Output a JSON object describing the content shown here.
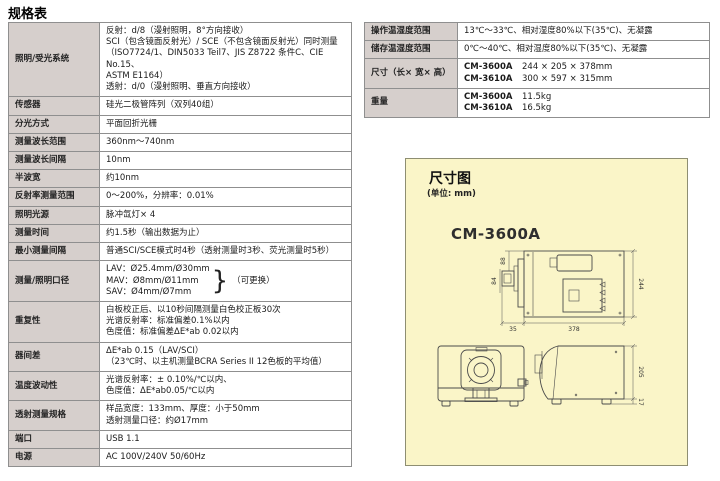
{
  "page": {
    "title": "规格表"
  },
  "left_table": {
    "rows": [
      {
        "label": "照明/受光系统",
        "lines": [
          "反射：d/8（漫射照明，8°方向接收）",
          "SCI（包含镜面反射光）/ SCE（不包含镜面反射光）同时测量",
          "（ISO7724/1、DIN5033 Teil7、JIS Z8722 条件C、CIE No.15、",
          "ASTM E1164）",
          "透射：d/0（漫射照明、垂直方向接收）"
        ]
      },
      {
        "label": "传感器",
        "lines": [
          "硅光二极管阵列（双列40组）"
        ]
      },
      {
        "label": "分光方式",
        "lines": [
          "平面回折光栅"
        ]
      },
      {
        "label": "测量波长范围",
        "lines": [
          "360nm～740nm"
        ]
      },
      {
        "label": "测量波长间隔",
        "lines": [
          "10nm"
        ]
      },
      {
        "label": "半波宽",
        "lines": [
          "约10nm"
        ]
      },
      {
        "label": "反射率测量范围",
        "lines": [
          "0～200%，分辨率：0.01%"
        ]
      },
      {
        "label": "照明光源",
        "lines": [
          "脉冲氙灯× 4"
        ]
      },
      {
        "label": "测量时间",
        "lines": [
          "约1.5秒（输出数据为止）"
        ]
      },
      {
        "label": "最小测量间隔",
        "lines": [
          "普通SCI/SCE模式时4秒（透射测量时3秒、荧光测量时5秒）"
        ]
      },
      {
        "label": "测量/照明口径",
        "lines": [
          "LAV：Ø25.4mm/Ø30mm",
          "MAV：Ø8mm/Ø11mm",
          "SAV：Ø4mm/Ø7mm"
        ],
        "brace_note": "（可更换）"
      },
      {
        "label": "重复性",
        "lines": [
          "白板校正后、以10秒间隔测量白色校正板30次",
          "光谱反射率：标准偏差0.1%以内",
          "色度值：标准偏差ΔE*ab 0.02以内"
        ]
      },
      {
        "label": "器间差",
        "lines": [
          "ΔE*ab 0.15（LAV/SCI）",
          "（23℃时、以主机测量BCRA Series II 12色板的平均值）"
        ]
      },
      {
        "label": "温度波动性",
        "lines": [
          "光谱反射率：± 0.10%/℃以内、",
          "色度值：ΔE*ab0.05/℃以内"
        ]
      },
      {
        "label": "透射测量规格",
        "lines": [
          "样品宽度：133mm、厚度：小于50mm",
          "透射测量口径：约Ø17mm"
        ]
      },
      {
        "label": "端口",
        "lines": [
          "USB 1.1"
        ]
      },
      {
        "label": "电源",
        "lines": [
          "AC 100V/240V 50/60Hz"
        ]
      }
    ]
  },
  "right_table": {
    "rows": [
      {
        "label": "操作温湿度范围",
        "lines": [
          "13℃～33℃、相对湿度80%以下(35℃)、无凝露"
        ]
      },
      {
        "label": "储存温湿度范围",
        "lines": [
          "0℃～40℃、相对湿度80%以下(35℃)、无凝露"
        ]
      },
      {
        "label": "尺寸（长× 宽× 高）",
        "lines": [
          [
            "CM-3600A",
            "244 × 205 × 378mm"
          ],
          [
            "CM-3610A",
            "300 × 597 × 315mm"
          ]
        ]
      },
      {
        "label": "重量",
        "lines": [
          [
            "CM-3600A",
            "11.5kg"
          ],
          [
            "CM-3610A",
            "16.5kg"
          ]
        ]
      }
    ]
  },
  "diagram": {
    "title": "尺寸图",
    "unit": "(单位: mm)",
    "model": "CM-3600A",
    "dims": {
      "top_left": "88",
      "left": "84",
      "right": "244",
      "bottom_left": "35",
      "bottom": "378",
      "side_height": "205",
      "foot": "17"
    }
  },
  "colors": {
    "label_cell_bg": "#d6cfcc",
    "table_border": "#8f8f8f",
    "diagram_bg": "#faf5c8",
    "diagram_border": "#8e8e72",
    "drawing_line": "#4a4a4a"
  }
}
